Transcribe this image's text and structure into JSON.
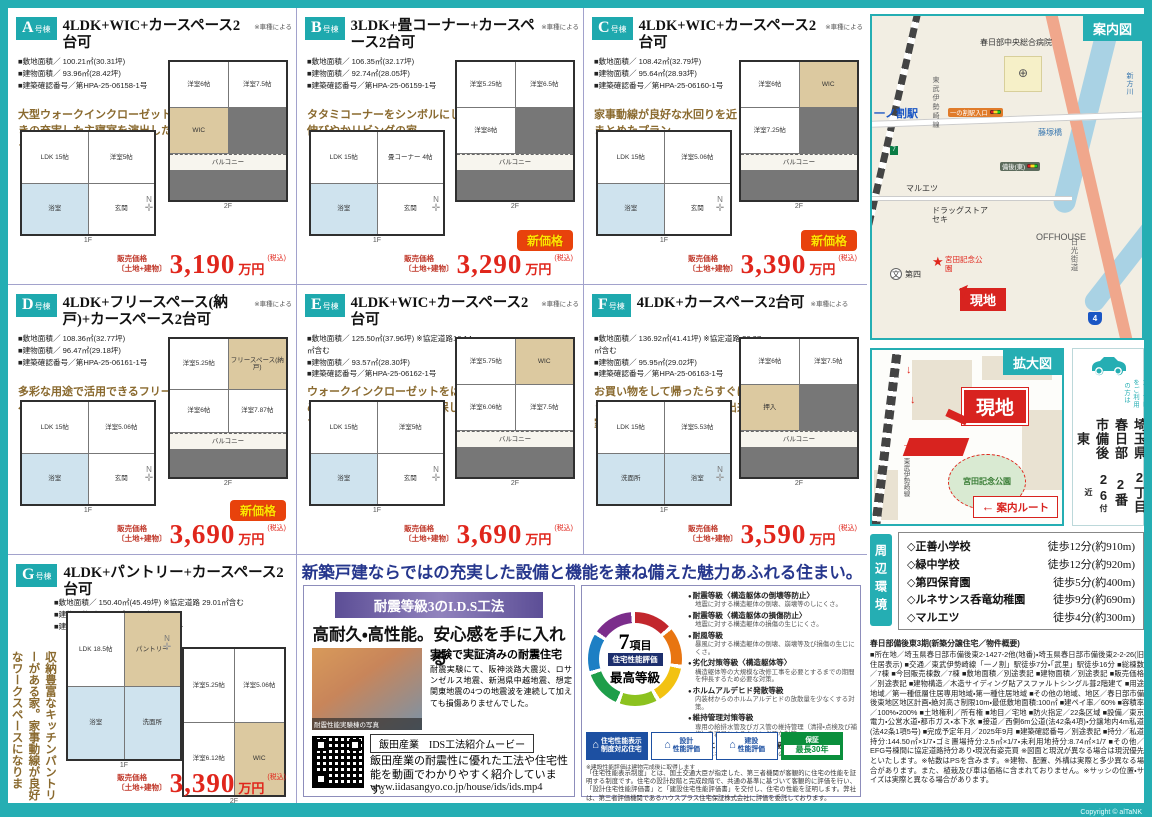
{
  "colors": {
    "accent_teal": "#25aeb3",
    "price_red": "#e0261c",
    "headline_navy": "#26378d",
    "banner_purple": "#5c4e96",
    "catch_brown": "#8a6a2f",
    "site_red": "#d8231f"
  },
  "page": {
    "copyright": "Copyright © alTaNK"
  },
  "shared": {
    "floor1": "1F",
    "floor2": "2F",
    "compass_n": "N",
    "price_label1": "販売価格",
    "price_label2": "〔土地+建物〕",
    "price_unit": "万円",
    "price_tax": "(税込)",
    "new_badge": "新価格"
  },
  "units": [
    {
      "tag": "A",
      "tag_suffix": "号棟",
      "title": "4LDK+WIC+カースペース2台可",
      "note": "※車種による",
      "specs": [
        "■敷地面積／ 100.21㎡(30.31坪)",
        "■建物面積／ 93.96㎡(28.42坪)",
        "■建築確認番号／第HPA-25-06158-1号"
      ],
      "catch": "大型ウォークインクローゼット付きの充実した主寝室を演出したプラン。",
      "price": "3,190",
      "new_price": false,
      "rooms1": [
        "LDK 15帖",
        "洋室5帖",
        "浴室",
        "玄関"
      ],
      "rooms2": [
        "洋室6帖",
        "洋室7.5帖",
        "WIC",
        "バルコニー"
      ]
    },
    {
      "tag": "B",
      "tag_suffix": "号棟",
      "title": "3LDK+畳コーナー+カースペース2台可",
      "note": "※車種による",
      "specs": [
        "■敷地面積／ 106.35㎡(32.17坪)",
        "■建物面積／ 92.74㎡(28.05坪)",
        "■建築確認番号／第HPA-25-06159-1号"
      ],
      "catch": "タタミコーナーをシンボルにした伸びやかリビングの家。",
      "price": "3,290",
      "new_price": true,
      "rooms1": [
        "LDK 15帖",
        "畳コーナー 4帖",
        "浴室",
        "玄関"
      ],
      "rooms2": [
        "洋室5.25帖",
        "洋室6.5帖",
        "洋室8帖",
        "バルコニー"
      ]
    },
    {
      "tag": "C",
      "tag_suffix": "号棟",
      "title": "4LDK+WIC+カースペース2台可",
      "note": "※車種による",
      "specs": [
        "■敷地面積／ 108.42㎡(32.79坪)",
        "■建物面積／ 95.64㎡(28.93坪)",
        "■建築確認番号／第HPA-25-06160-1号"
      ],
      "catch": "家事動線が良好な水回りを近くにまとめたプラン。",
      "price": "3,390",
      "new_price": true,
      "rooms1": [
        "LDK 15帖",
        "洋室5.06帖",
        "浴室",
        "玄関"
      ],
      "rooms2": [
        "洋室6帖",
        "WIC",
        "洋室7.25帖",
        "バルコニー"
      ]
    },
    {
      "tag": "D",
      "tag_suffix": "号棟",
      "title": "4LDK+フリースペース(納戸)+カースペース2台可",
      "note": "※車種による",
      "specs": [
        "■敷地面積／ 108.36㎡(32.77坪)",
        "■建物面積／ 96.47㎡(29.18坪)",
        "■建築確認番号／第HPA-25-06161-1号"
      ],
      "catch": "多彩な用途で活用できるフリースペース付きプラン！",
      "price": "3,690",
      "new_price": true,
      "rooms1": [
        "LDK 15帖",
        "洋室5.06帖",
        "浴室",
        "玄関"
      ],
      "rooms2": [
        "洋室5.25帖",
        "フリースペース(納戸)",
        "洋室6帖",
        "洋室7.87帖",
        "バルコニー"
      ]
    },
    {
      "tag": "E",
      "tag_suffix": "号棟",
      "title": "4LDK+WIC+カースペース2台可",
      "note": "※車種による",
      "specs": [
        "■敷地面積／ 125.50㎡(37.96坪) ※協定道路16.14㎡含む",
        "■建物面積／ 93.57㎡(28.30坪)",
        "■建築確認番号／第HPA-25-06162-1号"
      ],
      "catch": "ウォークインクローゼットをはじめ充実の収納スペースを確保したプラン。",
      "price": "3,690",
      "new_price": false,
      "rooms1": [
        "LDK 15帖",
        "洋室5帖",
        "浴室",
        "玄関"
      ],
      "rooms2": [
        "洋室5.75帖",
        "WIC",
        "洋室6.06帖",
        "洋室7.5帖",
        "バルコニー"
      ]
    },
    {
      "tag": "F",
      "tag_suffix": "号棟",
      "title": "4LDK+カースペース2台可",
      "note": "※車種による",
      "specs": [
        "■敷地面積／ 136.92㎡(41.41坪) ※協定道路 26.07㎡含む",
        "■建物面積／ 95.95㎡(29.02坪)",
        "■建築確認番号／第HPA-25-06163-1号"
      ],
      "catch": "お買い物をして帰ったらすぐにキッチンへ荷物を運ぶことが出来る家事動線が良好なプラン。",
      "price": "3,590",
      "new_price": false,
      "rooms1": [
        "LDK 15帖",
        "洋室5.53帖",
        "洗面所",
        "浴室"
      ],
      "rooms2": [
        "洋室6帖",
        "洋室7.5帖",
        "押入",
        "バルコニー"
      ]
    },
    {
      "tag": "G",
      "tag_suffix": "号棟",
      "title": "4LDK+パントリー+カースペース2台可",
      "note": "",
      "specs": [
        "■敷地面積／ 150.40㎡(45.49坪) ※協定道路 29.01㎡含む",
        "■建物面積／ 96.46㎡(29.17坪)",
        "■建築確認番号／第HPA-25-06164-1号"
      ],
      "catch": "収納豊富なキッチンパントリーがある家。家事動線が良好なワークスペースになります。",
      "price": "3,390",
      "new_price": false,
      "layout": "g-layout",
      "rooms1": [
        "LDK 18.5帖",
        "パントリー",
        "浴室",
        "洗面所"
      ],
      "rooms2": [
        "洋室5.25帖",
        "洋室5.06帖",
        "洋室6.12帖",
        "WIC"
      ]
    }
  ],
  "promo": {
    "headline": "新築戸建ならではの充実した設備と機能を兼ね備えた魅力あふれる住まい。",
    "ids": {
      "banner": "耐震等級3のI.D.S工法",
      "headline": "高耐久・高性能。安心感を手に入れる",
      "photo_caption": "耐震性能実験棟の写真",
      "proof_title": "実験で実証済みの耐震住宅",
      "proof_text": "耐震実験にて、阪神淡路大震災、ロサンゼルス地震、新潟県中越地震、想定関東地震の4つの地震波を連続して加えても損傷ありませんでした。",
      "movie_label": "飯田産業　IDS工法紹介ムービー",
      "movie_text": "飯田産業の耐震性に優れた工法や住宅性能を動画でわかりやすく紹介しています。",
      "movie_url": "www.iidasangyo.co.jp/house/ids/ids.mp4"
    },
    "rating": {
      "count_big": "7",
      "count_small": "項目",
      "band": "住宅性能評価",
      "grade": "最高等級",
      "items": [
        {
          "t": "耐震等級〈構造躯体の倒壊等防止〉",
          "d": "地震に対する構造躯体の倒壊、崩壊等のしにくさ。"
        },
        {
          "t": "耐震等級〈構造躯体の損傷防止〉",
          "d": "地震に対する構造躯体の損傷の生じにくさ。"
        },
        {
          "t": "耐風等級",
          "d": "暴風に対する構造躯体の倒壊、崩壊等及び損傷の生じにくさ。"
        },
        {
          "t": "劣化対策等級〈構造躯体等〉",
          "d": "構造躯体等の大規模な改修工事を必要とするまでの期間を伸長するため必要な対策。"
        },
        {
          "t": "ホルムアルデヒド発散等級",
          "d": "内装材からのホルムアルデヒドの放散量を少なくする対策。"
        },
        {
          "t": "維持管理対策等級",
          "d": "専用の給排水管及びガス管の維持管理（清掃・点検及び補修）を容易とするために必要な対策。"
        },
        {
          "t": "一次エネルギー消費量等級",
          "d": "一次エネルギー消費量の削減のための対策。"
        }
      ],
      "badges": [
        {
          "t": "住宅性能表示",
          "b": "制度対応住宅"
        },
        {
          "t": "設計",
          "b": "性能評価"
        },
        {
          "t": "建設",
          "b": "性能評価"
        },
        {
          "t": "保証",
          "b": "最長30年"
        }
      ],
      "badge_note": "※建設性能評価は建物完成後に取得します",
      "fine_print": "「住宅性能表示制度」とは、国土交通大臣が指定した、第三者機関が客観的に住宅の性能を証明する制度です。住宅の設計段階と完成段階で、共通の基準に基づいて客観的に評価を行い、「設計住宅性能評価書」と「建設住宅性能評価書」を交付し、住宅の性能を証明します。弊社は、第三者評価機関であるハウスプラス住宅保証株式会社に評価を委託しております。"
    }
  },
  "guide_map": {
    "title": "案内図",
    "station": "一ノ割駅",
    "hospital": "春日部中央総合病院",
    "signal1": "一の割駅入口",
    "signal2": "備後(東)",
    "bridge": "藤塚橋",
    "maruetsu": "マルエツ",
    "drugstore": "ドラッグストア セキ",
    "rail_line": "東武伊勢崎線",
    "park": "宮田記念公園",
    "site": "現地",
    "school": "第四",
    "offhouse": "OFFHOUSE",
    "road": "日光街道",
    "river": "新方川",
    "route_no": "4",
    "seven": "7"
  },
  "enlarged_map": {
    "title": "拡大図",
    "site": "現地",
    "park": "宮田記念公園",
    "rail_line": "東武伊勢崎線",
    "route": "案内ルート",
    "arrow": "←"
  },
  "address": {
    "nav_note": "カーナビをご利用の方は",
    "line1": "埼玉県春日部市備後東",
    "line2": "2丁目2番26",
    "suffix": "付近"
  },
  "surroundings": {
    "title": "周辺環境",
    "items": [
      {
        "name": "◇正善小学校",
        "time": "徒歩12分(約910m)"
      },
      {
        "name": "◇緑中学校",
        "time": "徒歩12分(約920m)"
      },
      {
        "name": "◇第四保育園",
        "time": "徒歩5分(約400m)"
      },
      {
        "name": "◇ルネサンス呑竜幼稚園",
        "time": "徒歩9分(約690m)"
      },
      {
        "name": "◇マルエツ",
        "time": "徒歩4分(約300m)"
      }
    ]
  },
  "overview": {
    "title": "春日部備後東3期(新築分譲住宅／物件概要)",
    "body": "■所在地／埼玉県春日部市備後東2-1427-2他(地番)・埼玉県春日部市備後東2-2-26(旧住居表示) ■交通／東武伊勢崎線「一ノ割」駅徒歩7分・「武里」駅徒歩16分 ■総棟数／7棟 ■今回販売棟数／7棟 ■敷地面積／別途表記 ■建物面積／別途表記 ■販売価格／別途表記 ■建物構造／木造サイディング貼アスファルトシングル葺2階建て ■用途地域／第一種低層住居専用地域・第一種住居地域 ■その他の地域、地区／春日部市備後東地区地区計画・絶対高さ制限10m・最低敷地面積:100㎡ ■建ペイ率／60% ■容積率／100%・200% ■土地権利／所有権 ■地目／宅地 ■防火指定／22条区域 ■設備／東京電力・公営水道・都市ガス・本下水 ■接道／西側6m公道(法42条4項)・分譲地内4m私道(法42条1項5号) ■完成予定年月／2025年9月 ■建築確認番号／別途表記 ■持分／私道持分:144.50㎡×1/7・ゴミ置場持分:2.5㎡×1/7・未利用地持分:8.74㎡×1/7 ■その他／EFG号棟間に協定道路持分あり・現況有姿売買 ※図面と現況が異なる場合は現況優先といたします。※帖数はPSを含みます。※建物、配置、外構は実際と多少異なる場合があります。また、植栽及び車は価格に含まれておりません。※サッシの位置・サイズは実際と異なる場合があります。"
  }
}
